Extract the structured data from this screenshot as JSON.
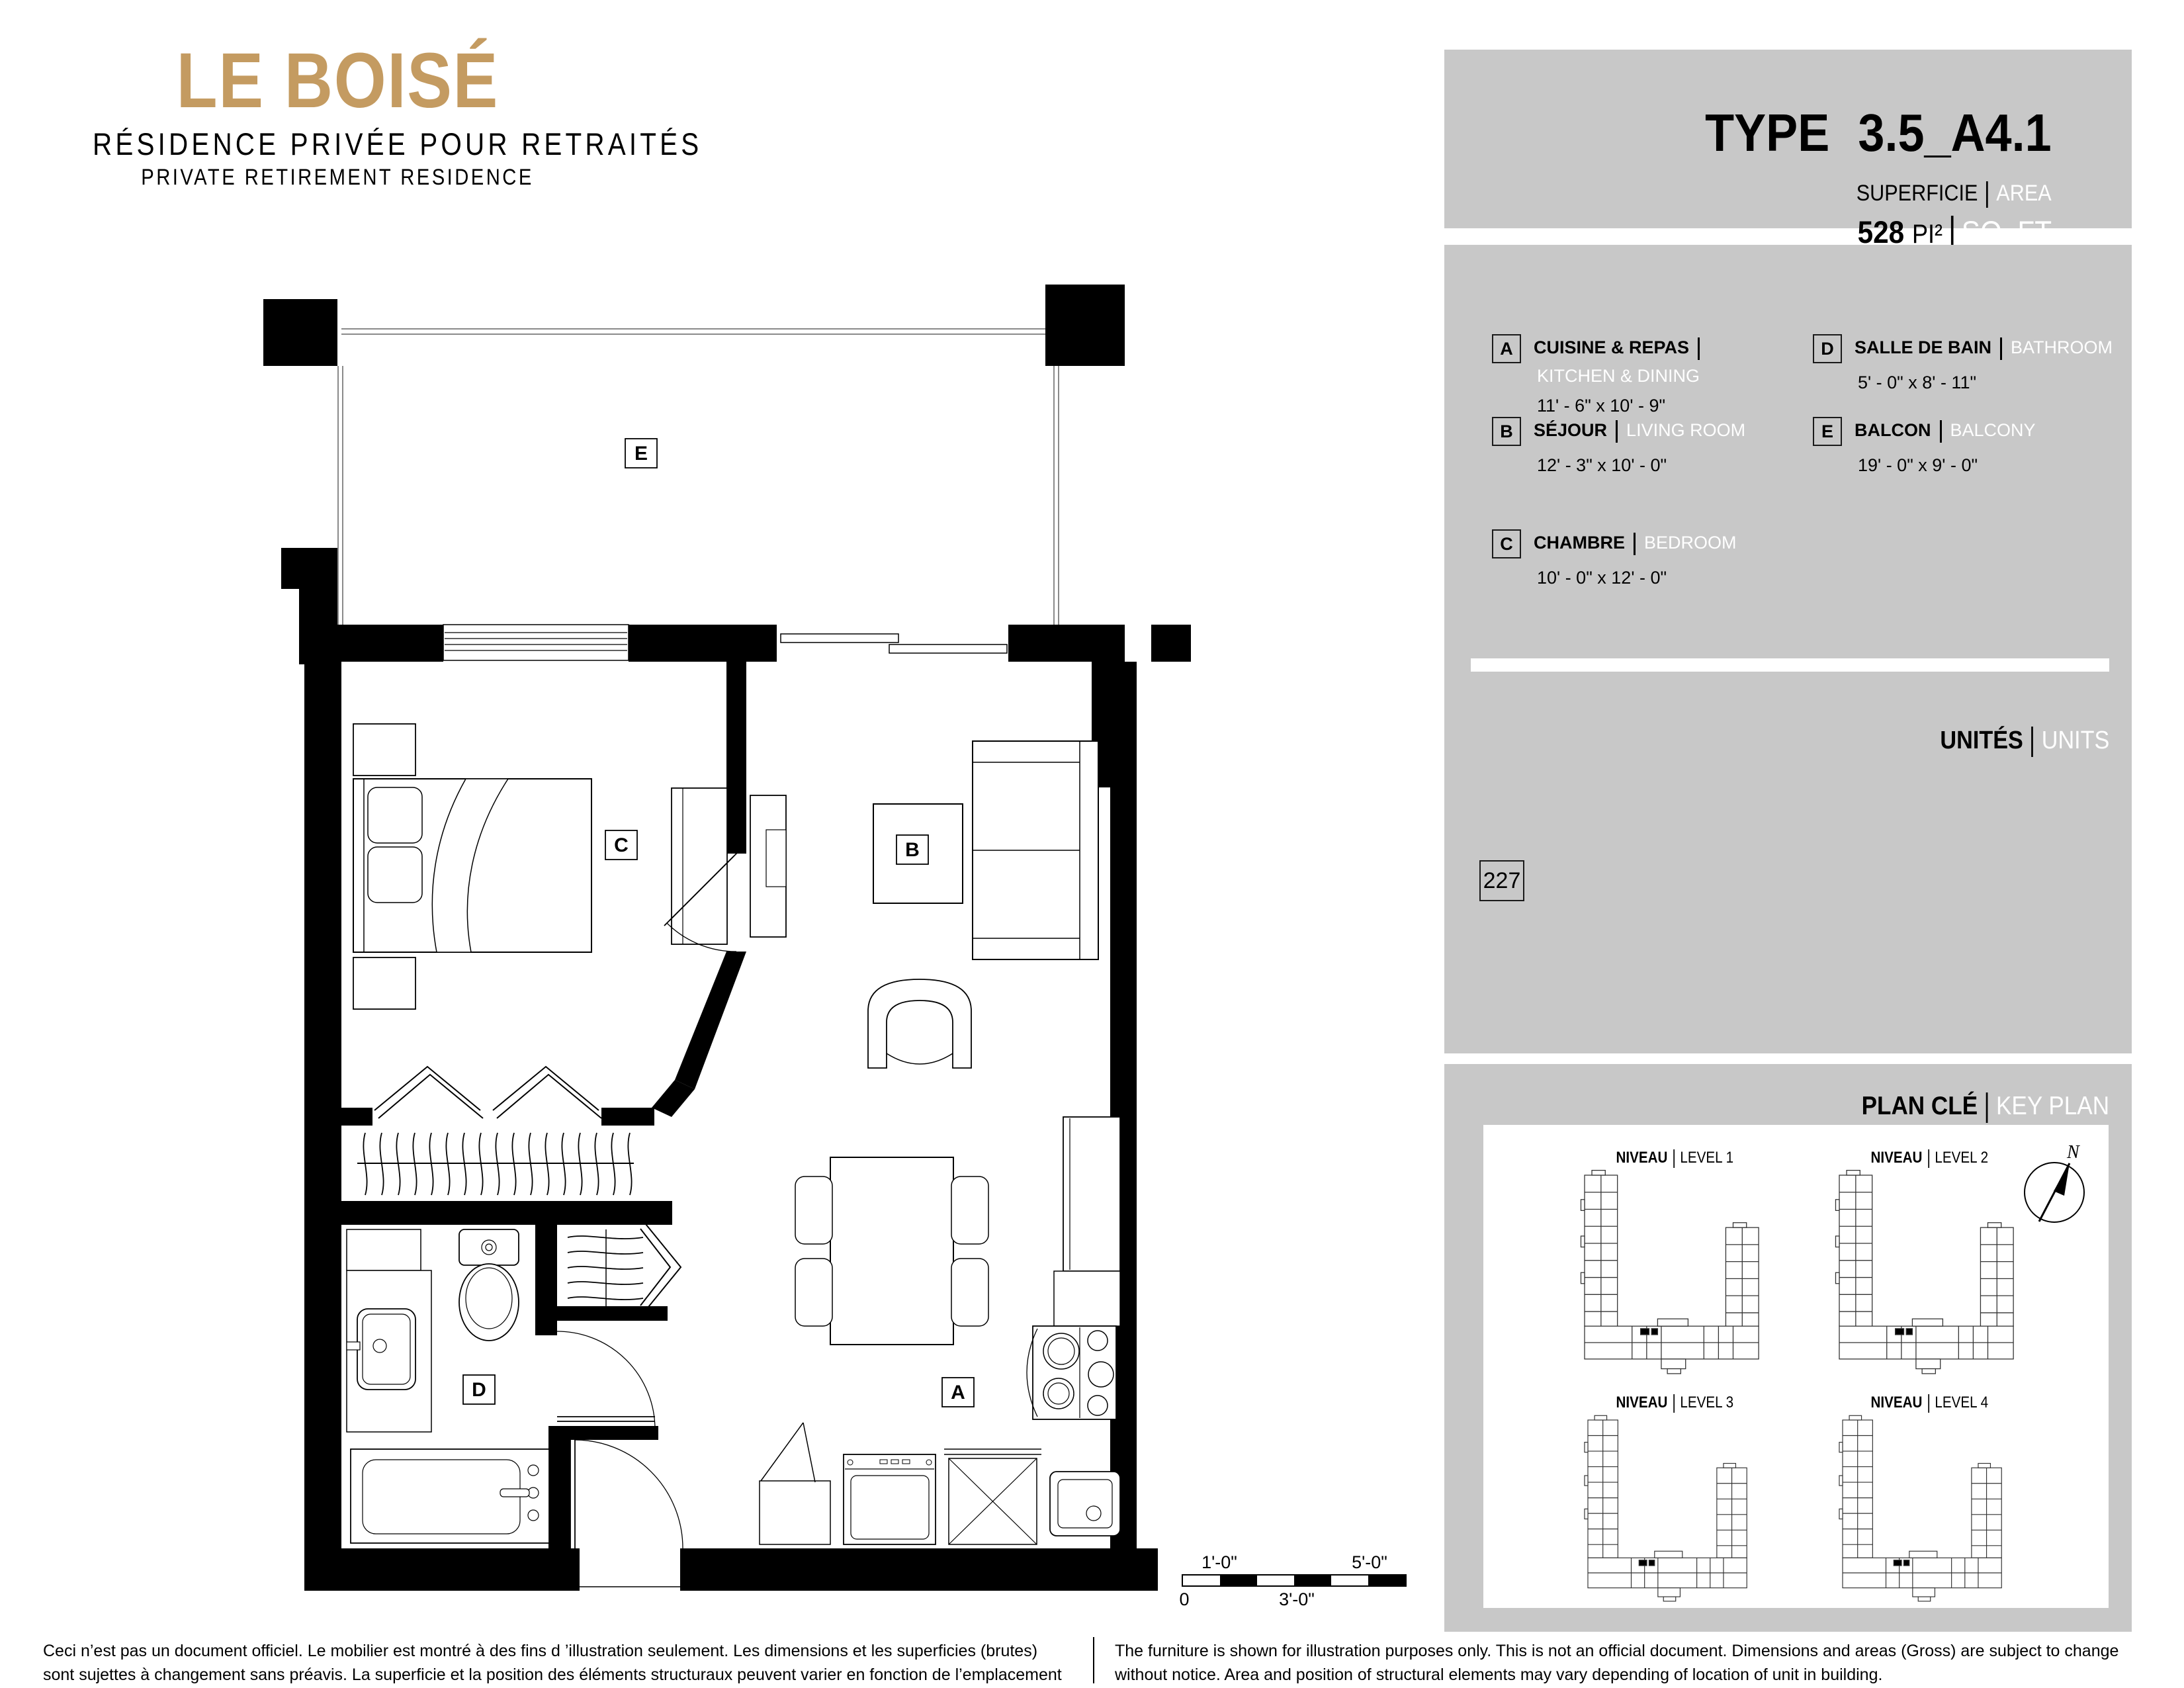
{
  "colors": {
    "logo_gold": "#C49B61",
    "panel_gray": "#C8C8C8",
    "keyplan_highlight": "#B5DBE2"
  },
  "logo": {
    "title": "LE BOISÉ",
    "subtitle_fr": "RÉSIDENCE PRIVÉE POUR RETRAITÉS",
    "subtitle_en": "PRIVATE RETIREMENT RESIDENCE"
  },
  "type_panel": {
    "label": "TYPE",
    "value": "3.5_A4.1",
    "area_label_fr": "SUPERFICIE",
    "area_label_en": "AREA",
    "area_value": "528",
    "area_unit_fr": "PI²",
    "area_unit_en": "SQ. FT"
  },
  "legend": {
    "items": [
      {
        "letter": "A",
        "name_fr": "CUISINE & REPAS",
        "name_en": "KITCHEN & DINING",
        "dims": "11' - 6\" x 10' - 9\""
      },
      {
        "letter": "B",
        "name_fr": "SÉJOUR",
        "name_en": "LIVING ROOM",
        "dims": "12' - 3\" x 10' - 0\""
      },
      {
        "letter": "C",
        "name_fr": "CHAMBRE",
        "name_en": "BEDROOM",
        "dims": "10' - 0\" x 12' - 0\""
      },
      {
        "letter": "D",
        "name_fr": "SALLE DE BAIN",
        "name_en": "BATHROOM",
        "dims": "5' - 0\" x 8' - 11\""
      },
      {
        "letter": "E",
        "name_fr": "BALCON",
        "name_en": "BALCONY",
        "dims": "19' - 0\" x 9' - 0\""
      }
    ]
  },
  "units": {
    "label_fr": "UNITÉS",
    "label_en": "UNITS",
    "numbers": [
      "227"
    ]
  },
  "keyplan": {
    "title_fr": "PLAN CLÉ",
    "title_en": "KEY PLAN",
    "level_label": "NIVEAU",
    "levels": [
      "LEVEL 1",
      "LEVEL 2",
      "LEVEL 3",
      "LEVEL 4"
    ],
    "highlighted_level": "LEVEL 2",
    "compass": "N"
  },
  "plan": {
    "labels": {
      "A": "A",
      "B": "B",
      "C": "C",
      "D": "D",
      "E": "E"
    }
  },
  "scalebar": {
    "top_left": "1'-0\"",
    "top_right": "5'-0\"",
    "bottom_left": "0",
    "bottom_mid": "3'-0\""
  },
  "disclaimer": {
    "fr": "Ceci n’est pas un document officiel.  Le mobilier est montré à des fins d ’illustration seulement.  Les dimensions et les superficies (brutes) sont sujettes à changement sans préavis. La superficie et la position des éléments structuraux peuvent varier en fonction de l’emplacement de l’unité dans le bâtiment.",
    "en": "The furniture is shown for illustration purposes only.  This is not an official document.  Dimensions and areas (Gross) are subject to change without notice.  Area and position of structural elements may vary depending of location of unit in building."
  }
}
